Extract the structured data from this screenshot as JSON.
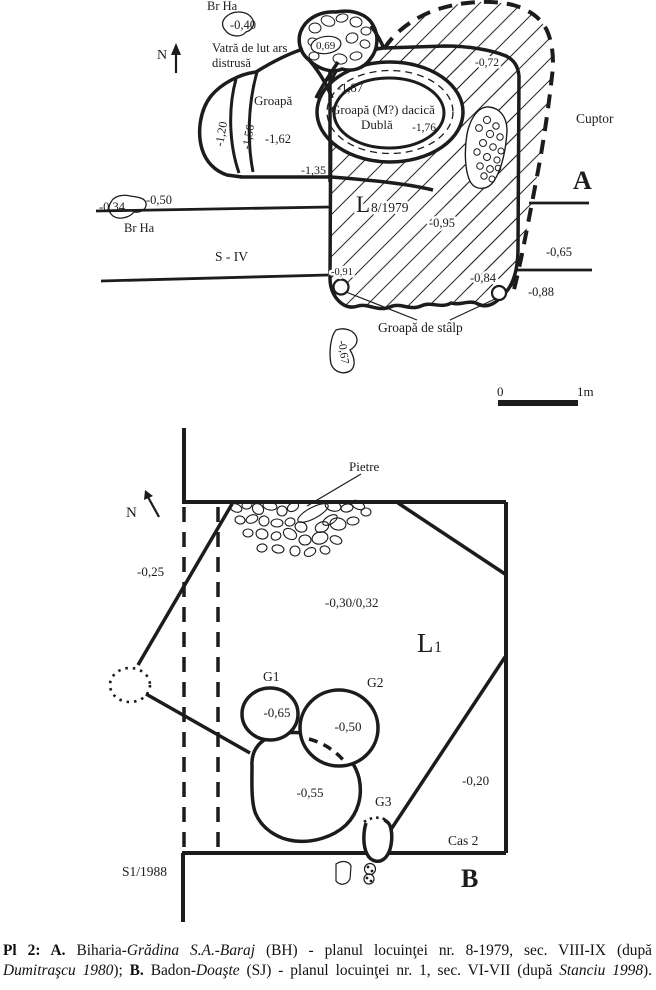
{
  "colors": {
    "paper": "#ffffff",
    "ink": "#1c1c1c"
  },
  "plan_a": {
    "plate_letter": "A",
    "north": "N",
    "br_ha_top": "Br Ha",
    "depth_040": "-0,40",
    "vatra_line1": "Vatră de lut ars",
    "vatra_line2": "distrusă",
    "hearth_depth": "0,69",
    "groapa": "Groapă",
    "depth_187": "-1,87",
    "dacian_line1": "Groapă (M?) dacică",
    "dacian_line2": "Dublă",
    "depth_176": "-1,76",
    "depth_072": "-0,72",
    "cuptor": "Cuptor",
    "depth_120": "-1,20",
    "depth_156": "-1,56",
    "depth_162": "-1,62",
    "depth_135": "-1,35",
    "depth_034": "-0,34",
    "depth_050": "-0,50",
    "br_ha_left": "Br Ha",
    "s_iv": "S - IV",
    "house_prefix": "L",
    "house_suffix": "8/1979",
    "depth_095": "-0,95",
    "depth_065": "-0,65",
    "depth_088": "-0,88",
    "depth_091": "-0,91",
    "depth_084": "-0,84",
    "groapa_de_stalp": "Groapă de stâlp",
    "depth_067": "-0,67",
    "scale_zero": "0",
    "scale_one_m": "1m"
  },
  "plan_b": {
    "plate_letter": "B",
    "north": "N",
    "pietre": "Pietre",
    "depth_025": "-0,25",
    "depth_030_032": "-0,30/0,32",
    "house_prefix": "L",
    "house_sub": "1",
    "g1": "G1",
    "depth_065": "-0,65",
    "g2": "G2",
    "depth_050": "-0,50",
    "depth_055": "-0,55",
    "g3": "G3",
    "depth_020": "-0,20",
    "cas_2": "Cas 2",
    "s1_1988": "S1/1988"
  },
  "caption": {
    "line1": [
      {
        "style": "bold",
        "text": "Pl 2: A."
      },
      {
        "style": "normal",
        "text": " Biharia-"
      },
      {
        "style": "italic",
        "text": "Grădina S.A.-Baraj"
      },
      {
        "style": "normal",
        "text": " (BH) - planul locuinţei nr. 8-1979, sec. VIII-IX (după"
      }
    ],
    "line2": [
      {
        "style": "italic",
        "text": "Dumitraşcu 1980"
      },
      {
        "style": "normal",
        "text": "); "
      },
      {
        "style": "bold",
        "text": "B."
      },
      {
        "style": "normal",
        "text": " Badon-"
      },
      {
        "style": "italic",
        "text": "Doaşte"
      },
      {
        "style": "normal",
        "text": " (SJ) - planul locuinţei nr. 1, sec. VI-VII (după "
      },
      {
        "style": "italic",
        "text": "Stanciu 1998"
      },
      {
        "style": "normal",
        "text": ")."
      }
    ]
  }
}
